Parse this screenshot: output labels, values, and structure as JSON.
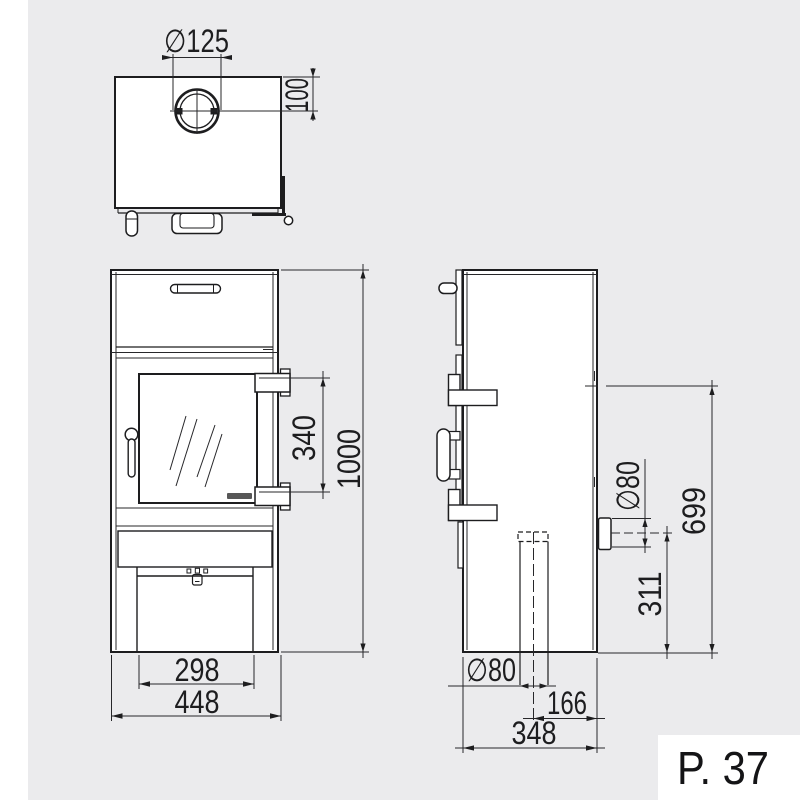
{
  "page": {
    "label": "P. 37",
    "background": "#ffffff",
    "panel_color": "#ebebed",
    "line_color": "#1d1d1f"
  },
  "dims": {
    "top_flue_diameter": "∅125",
    "top_flue_rear_offset": "100",
    "hinge_span_height": "340",
    "total_height": "1000",
    "base_inner_width": "298",
    "total_width": "448",
    "rear_flue_diameter": "∅80",
    "upper_outlet_height": "699",
    "rear_flue_center_height": "311",
    "bottom_flue_diameter": "∅80",
    "bottom_flue_center_offset": "166",
    "total_depth": "348"
  }
}
